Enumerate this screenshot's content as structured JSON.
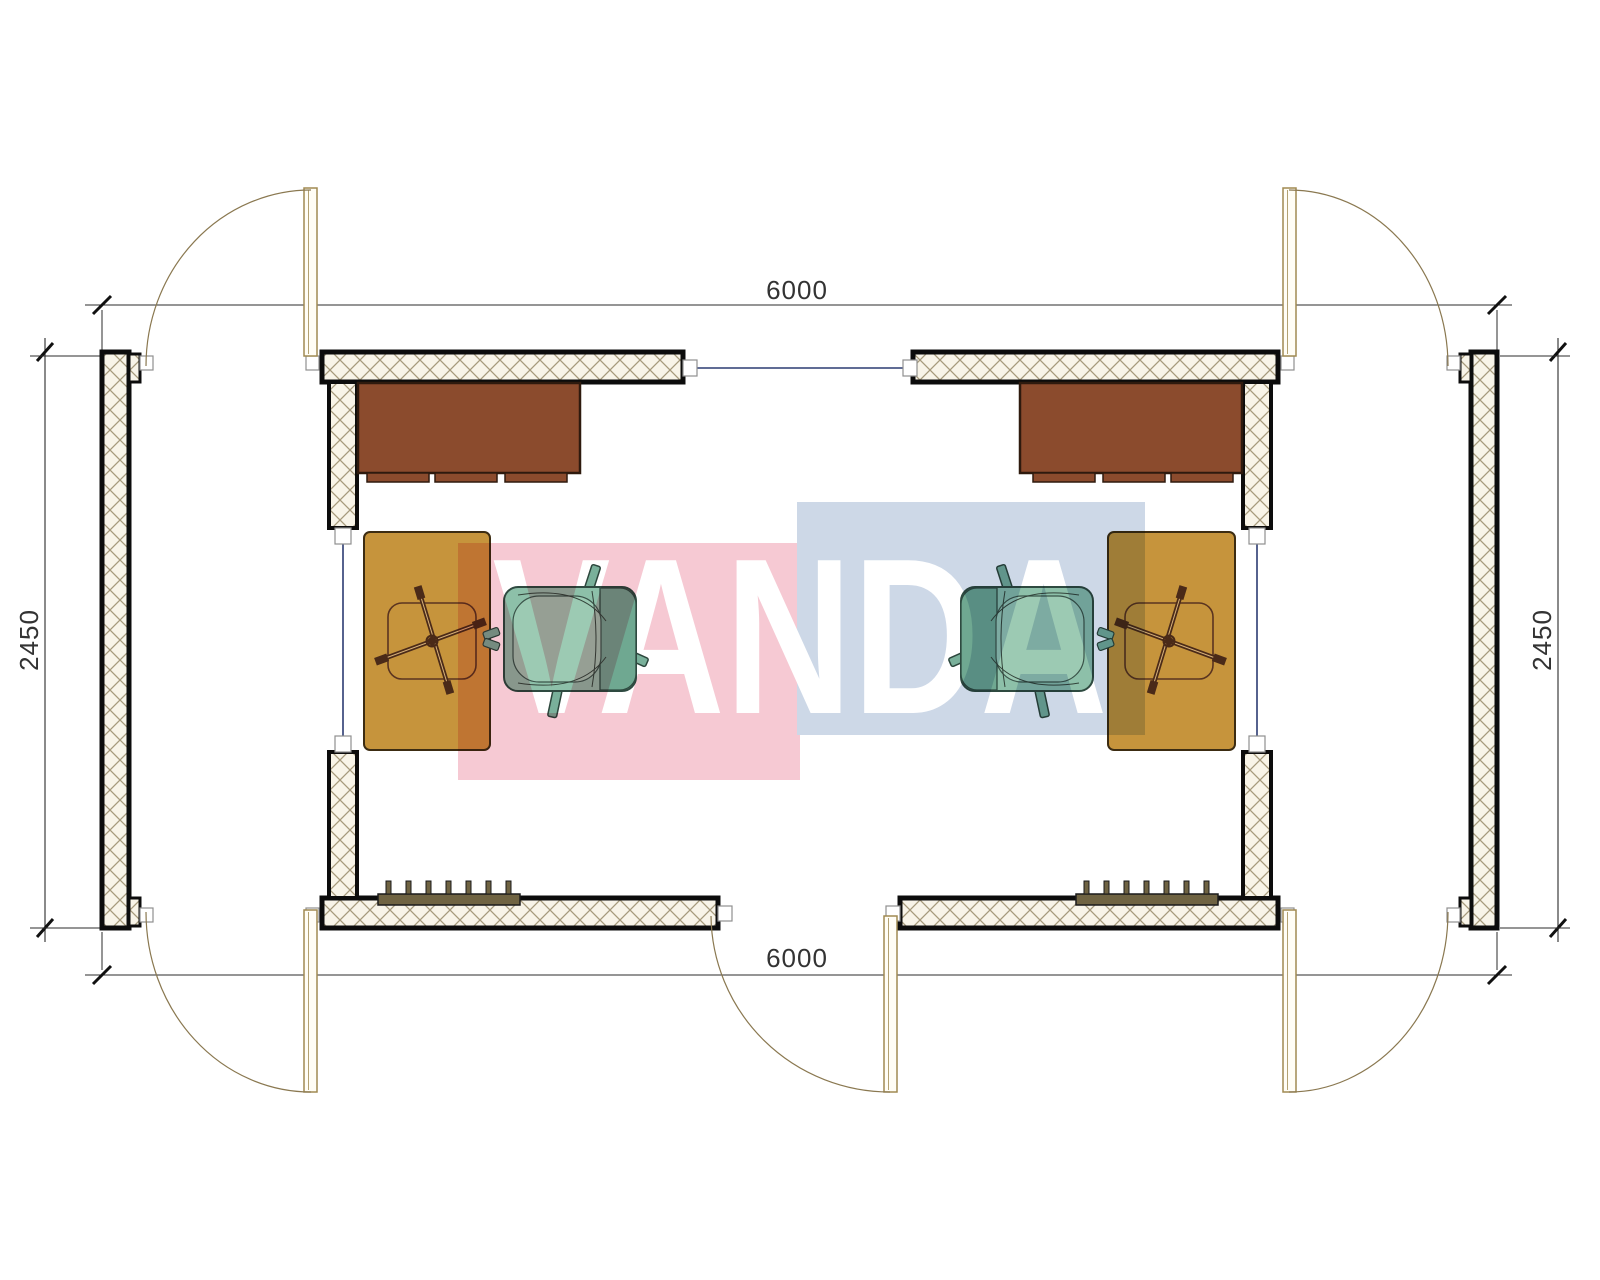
{
  "drawing": {
    "kind": "modular-cabin-floor-plan",
    "modules": 2,
    "doors": 5,
    "furniture_per_module": [
      "wardrobe",
      "desk",
      "office-chair-base",
      "armchair",
      "radiator"
    ]
  },
  "dimensions": {
    "top": "6000",
    "bottom": "6000",
    "left": "2450",
    "right": "2450"
  },
  "watermark": {
    "text": "VANDA",
    "pink": "#f6c9d3",
    "blue": "#cdd8e7",
    "text_color": "#ffffff"
  },
  "colors": {
    "wall_outline": "#0c0c0c",
    "wall_fill": "#f8f4e8",
    "hatch_line": "#a69a7c",
    "cabinet": "#8b4b2d",
    "cabinet_outline": "#2e1a0e",
    "desk": "#c6943c",
    "desk_outline": "#3c2c12",
    "chair_body": "#8dc0a9",
    "chair_seat": "#9ccab3",
    "chair_back": "#6fa891",
    "chair_outline": "#2e4a40",
    "radiator": "#6f6342",
    "star_base": "#4a2a18",
    "door": "#a08a52",
    "joint_line": "#2c3b72",
    "dimension_text": "#333333"
  }
}
